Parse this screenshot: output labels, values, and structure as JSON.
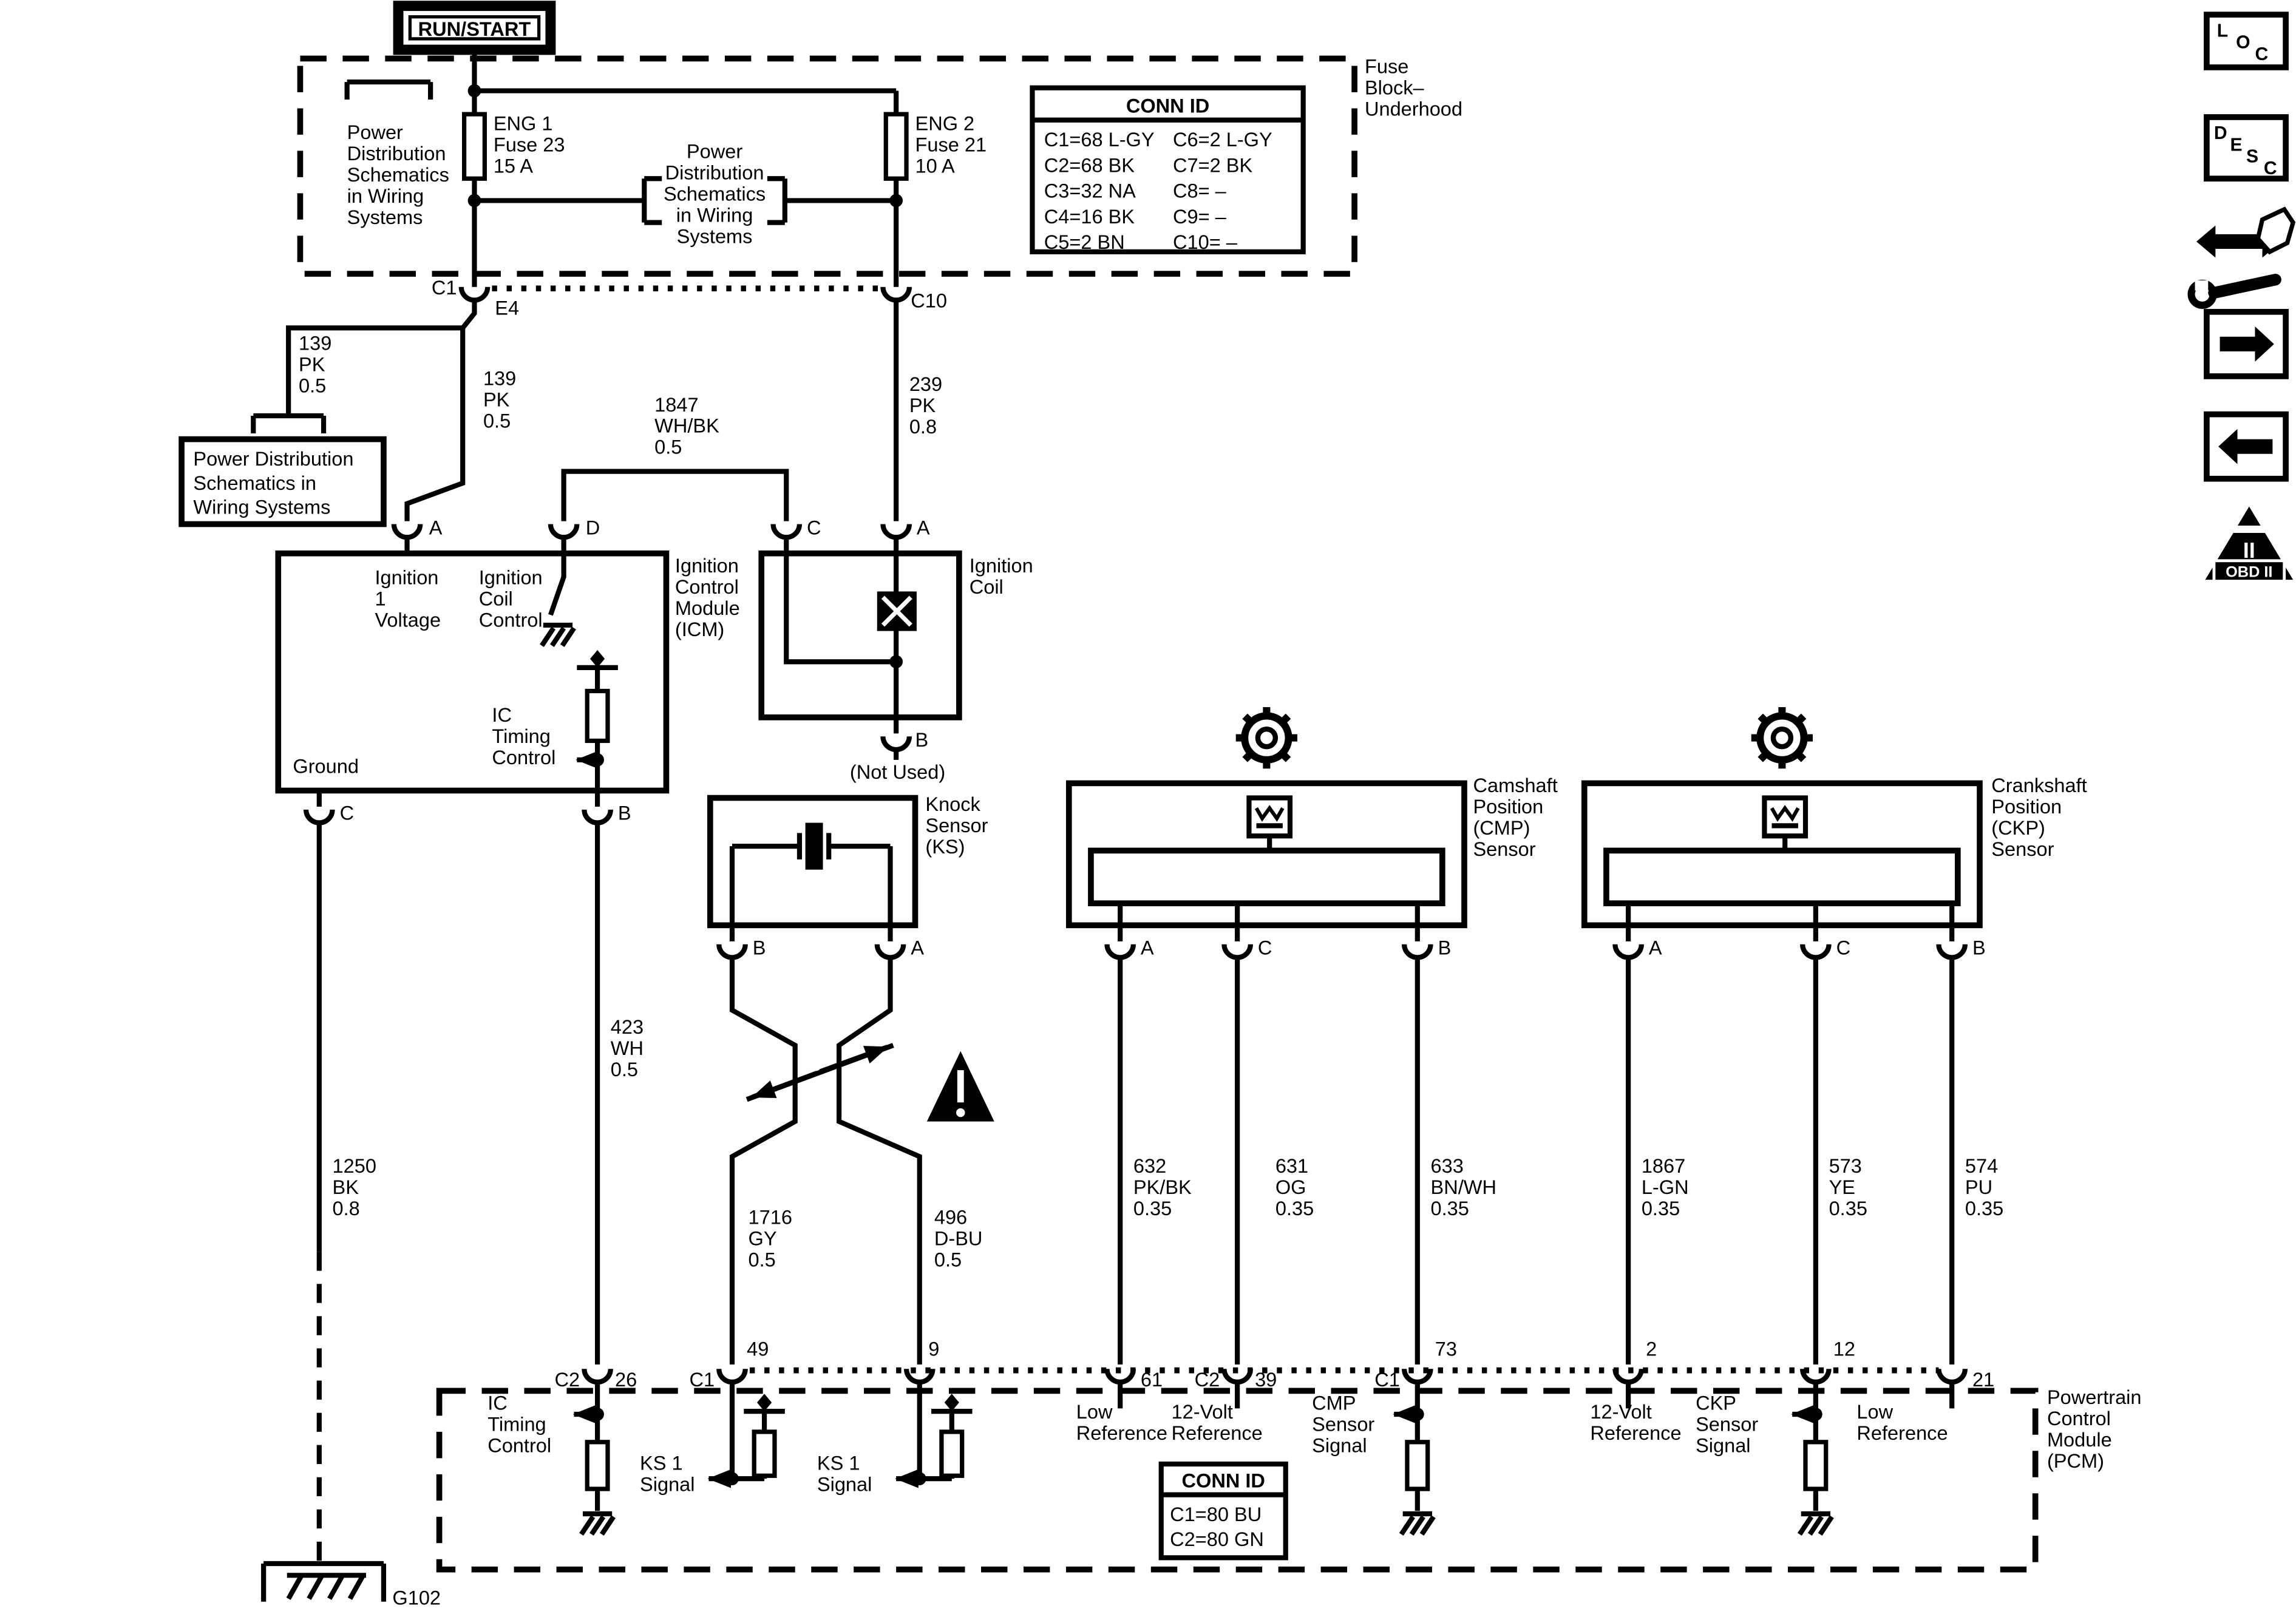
{
  "header": {
    "run_start": "RUN/START"
  },
  "fuse_block": {
    "label_lines": [
      "Fuse",
      "Block–",
      "Underhood"
    ],
    "left_ref_lines": [
      "Power",
      "Distribution",
      "Schematics",
      "in Wiring",
      "Systems"
    ],
    "mid_ref_lines": [
      "Power",
      "Distribution",
      "Schematics",
      "in Wiring",
      "Systems"
    ],
    "fuse1_lines": [
      "ENG 1",
      "Fuse 23",
      "15 A"
    ],
    "fuse2_lines": [
      "ENG 2",
      "Fuse 21",
      "10 A"
    ],
    "conn_table": {
      "title": "CONN ID",
      "col1": [
        "C1=68 L-GY",
        "C2=68 BK",
        "C3=32 NA",
        "C4=16 BK",
        "C5=2 BN"
      ],
      "col2": [
        "C6=2 L-GY",
        "C7=2 BK",
        "C8= –",
        "C9= –",
        "C10= –"
      ]
    },
    "c1": "C1",
    "e4": "E4",
    "c10": "C10"
  },
  "ref_box_lines": [
    "Power Distribution",
    "Schematics in",
    "Wiring Systems"
  ],
  "wires": {
    "w139a": [
      "139",
      "PK",
      "0.5"
    ],
    "w139b": [
      "139",
      "PK",
      "0.5"
    ],
    "w1847": [
      "1847",
      "WH/BK",
      "0.5"
    ],
    "w239": [
      "239",
      "PK",
      "0.8"
    ],
    "w423": [
      "423",
      "WH",
      "0.5"
    ],
    "w1250": [
      "1250",
      "BK",
      "0.8"
    ],
    "w1716": [
      "1716",
      "GY",
      "0.5"
    ],
    "w496": [
      "496",
      "D-BU",
      "0.5"
    ],
    "w632": [
      "632",
      "PK/BK",
      "0.35"
    ],
    "w631": [
      "631",
      "OG",
      "0.35"
    ],
    "w633": [
      "633",
      "BN/WH",
      "0.35"
    ],
    "w1867": [
      "1867",
      "L-GN",
      "0.35"
    ],
    "w573": [
      "573",
      "YE",
      "0.35"
    ],
    "w574": [
      "574",
      "PU",
      "0.35"
    ]
  },
  "icm": {
    "label_lines": [
      "Ignition",
      "Control",
      "Module",
      "(ICM)"
    ],
    "pin_a": "A",
    "pin_d": "D",
    "pin_c": "C",
    "pin_b": "B",
    "ign1_lines": [
      "Ignition",
      "1",
      "Voltage"
    ],
    "coil_ctl_lines": [
      "Ignition",
      "Coil",
      "Control"
    ],
    "ic_timing_lines": [
      "IC",
      "Timing",
      "Control"
    ],
    "ground": "Ground"
  },
  "coil": {
    "label_lines": [
      "Ignition",
      "Coil"
    ],
    "pin_c": "C",
    "pin_a": "A",
    "pin_b": "B",
    "not_used": "(Not Used)"
  },
  "ks": {
    "label_lines": [
      "Knock",
      "Sensor",
      "(KS)"
    ],
    "pin_b": "B",
    "pin_a": "A"
  },
  "cmp": {
    "label_lines": [
      "Camshaft",
      "Position",
      "(CMP)",
      "Sensor"
    ],
    "pin_a": "A",
    "pin_c": "C",
    "pin_b": "B"
  },
  "ckp": {
    "label_lines": [
      "Crankshaft",
      "Position",
      "(CKP)",
      "Sensor"
    ],
    "pin_a": "A",
    "pin_c": "C",
    "pin_b": "B"
  },
  "pcm": {
    "label_lines": [
      "Powertrain",
      "Control",
      "Module",
      "(PCM)"
    ],
    "pins": {
      "p26c": "C2",
      "p26": "26",
      "p49c": "C1",
      "p49": "49",
      "p9": "9",
      "p61": "61",
      "p39c": "C2",
      "p39": "39",
      "p73c": "C1",
      "p73": "73",
      "p2": "2",
      "p12": "12",
      "p21": "21"
    },
    "sig_ic_lines": [
      "IC",
      "Timing",
      "Control"
    ],
    "sig_ks1_lines": [
      "KS 1",
      "Signal"
    ],
    "sig_ks2_lines": [
      "KS 1",
      "Signal"
    ],
    "sig_lowref1_lines": [
      "Low",
      "Reference"
    ],
    "sig_12v1_lines": [
      "12-Volt",
      "Reference"
    ],
    "sig_cmp_lines": [
      "CMP",
      "Sensor",
      "Signal"
    ],
    "sig_12v2_lines": [
      "12-Volt",
      "Reference"
    ],
    "sig_ckp_lines": [
      "CKP",
      "Sensor",
      "Signal"
    ],
    "sig_lowref2_lines": [
      "Low",
      "Reference"
    ],
    "conn_table": {
      "title": "CONN ID",
      "rows": [
        "C1=80 BU",
        "C2=80 GN"
      ]
    }
  },
  "ground_label": "G102",
  "sidebar": {
    "loc": [
      "L",
      "O",
      "C"
    ],
    "desc": [
      "D",
      "E",
      "S",
      "C"
    ],
    "obd": {
      "pillar": "II",
      "label": "OBD II"
    }
  },
  "colors": {
    "line": "#000000",
    "bg": "#ffffff"
  }
}
